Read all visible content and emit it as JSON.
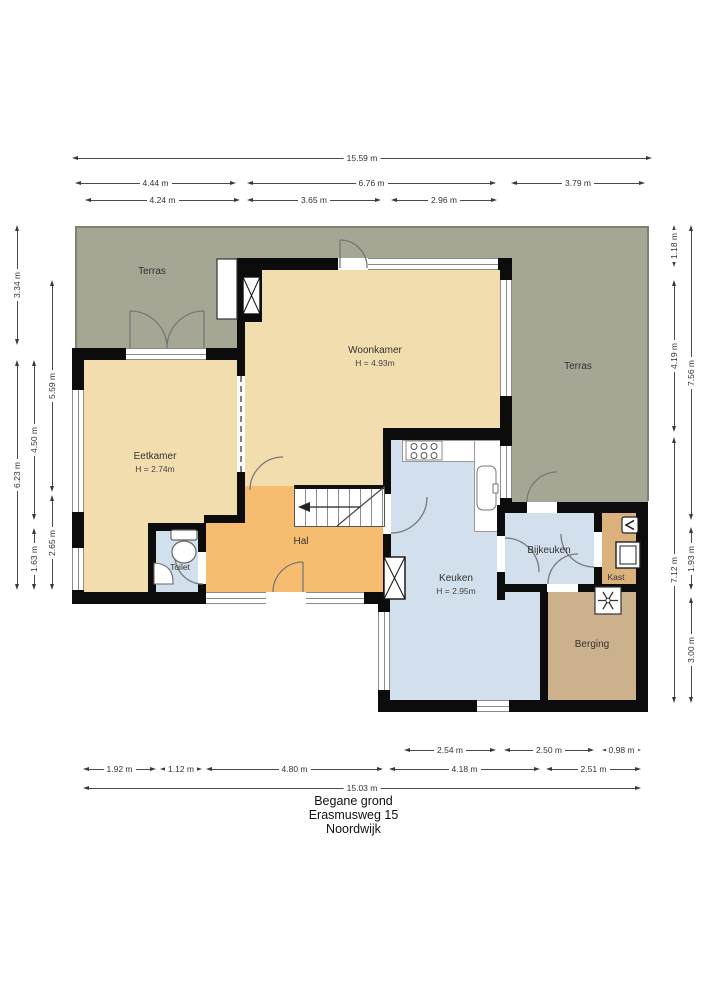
{
  "title": {
    "line1": "Begane grond",
    "line2": "Erasmusweg 15",
    "line3": "Noordwijk"
  },
  "rooms": {
    "terras_left": {
      "label": "Terras"
    },
    "woonkamer": {
      "label": "Woonkamer",
      "height": "H = 4.93m"
    },
    "terras_right": {
      "label": "Terras"
    },
    "eetkamer": {
      "label": "Eetkamer",
      "height": "H = 2.74m"
    },
    "toilet": {
      "label": "Toilet"
    },
    "hal": {
      "label": "Hal"
    },
    "keuken": {
      "label": "Keuken",
      "height": "H = 2.95m"
    },
    "bijkeuken": {
      "label": "Bijkeuken"
    },
    "kast": {
      "label": "Kast"
    },
    "berging": {
      "label": "Berging"
    }
  },
  "dimensions": {
    "top": [
      "15.59 m",
      "4.44 m",
      "6.76 m",
      "3.79 m",
      "4.24 m",
      "3.65 m",
      "2.96 m"
    ],
    "left": [
      "3.34 m",
      "6.23 m",
      "4.50 m",
      "1.63 m",
      "5.59 m",
      "2.65 m"
    ],
    "right": [
      "1.18 m",
      "4.19 m",
      "7.12 m",
      "7.56 m",
      "1.93 m",
      "3.00 m"
    ],
    "bottom": [
      "2.54 m",
      "2.50 m",
      "0.98 m",
      "1.92 m",
      "1.12 m",
      "4.80 m",
      "4.18 m",
      "2.51 m",
      "15.03 m"
    ]
  },
  "colors": {
    "terras": "#a5a693",
    "room_tan": "#f2ddae",
    "hal_orange": "#f6bd70",
    "room_blue": "#d2dfec",
    "kast_tan": "#dcb27c",
    "berging_tan": "#ccb18d",
    "wall": "#0c0c0c",
    "terras_border": "#7e8071"
  }
}
